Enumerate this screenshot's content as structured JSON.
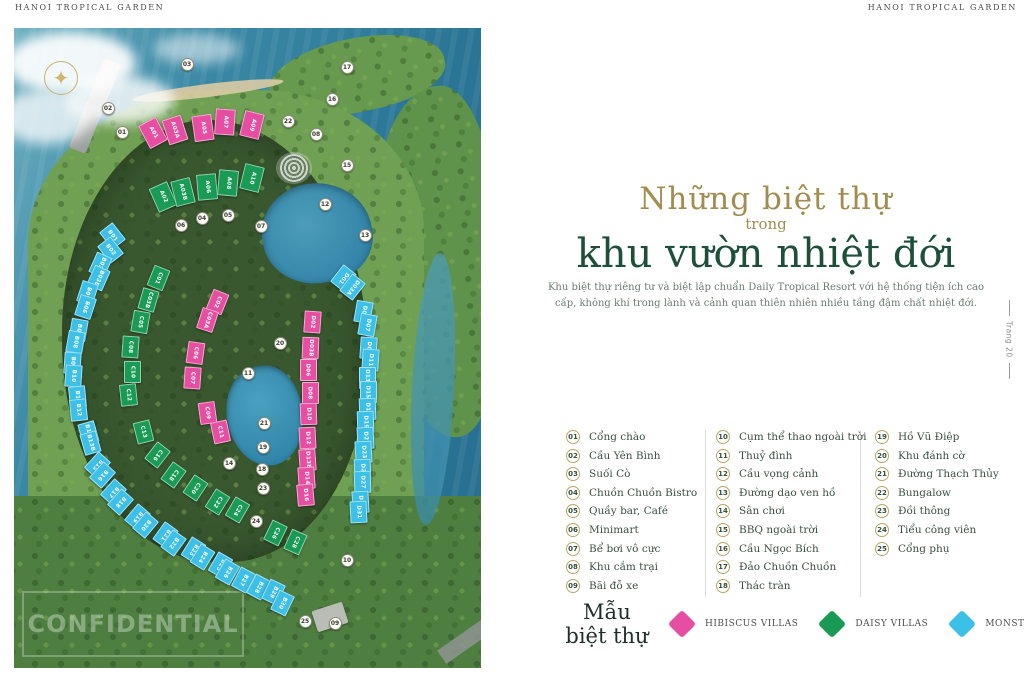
{
  "header": {
    "left": "HANOI TROPICAL GARDEN",
    "right": "HANOI TROPICAL GARDEN"
  },
  "page_tab": "Trang 20",
  "title": {
    "line1": "Những biệt thự",
    "line2": "trong",
    "line3": "khu vườn nhiệt đới"
  },
  "description": "Khu biệt thự riêng tư và biệt lập chuẩn Daily Tropical Resort với hệ thống tiện ích cao cấp, không khí trong lành và cảnh quan thiên nhiên nhiều tầng đậm chất nhiệt đới.",
  "legend": {
    "columns": [
      [
        {
          "num": "01",
          "label": "Cổng chào"
        },
        {
          "num": "02",
          "label": "Cầu Yên Bình"
        },
        {
          "num": "03",
          "label": "Suối Cò"
        },
        {
          "num": "04",
          "label": "Chuồn Chuồn Bistro"
        },
        {
          "num": "05",
          "label": "Quầy bar, Café"
        },
        {
          "num": "06",
          "label": "Minimart"
        },
        {
          "num": "07",
          "label": "Bể bơi vô cực"
        },
        {
          "num": "08",
          "label": "Khu cắm trại"
        },
        {
          "num": "09",
          "label": "Bãi đỗ xe"
        }
      ],
      [
        {
          "num": "10",
          "label": "Cụm thể thao ngoài trời"
        },
        {
          "num": "11",
          "label": "Thuỷ đình"
        },
        {
          "num": "12",
          "label": "Cầu vọng cảnh"
        },
        {
          "num": "13",
          "label": "Đường dạo ven hồ"
        },
        {
          "num": "14",
          "label": "Sân chơi"
        },
        {
          "num": "15",
          "label": "BBQ ngoài trời"
        },
        {
          "num": "16",
          "label": "Cầu Ngọc Bích"
        },
        {
          "num": "17",
          "label": "Đảo Chuồn Chuồn"
        },
        {
          "num": "18",
          "label": "Thác tràn"
        }
      ],
      [
        {
          "num": "19",
          "label": "Hồ Vũ Điệp"
        },
        {
          "num": "20",
          "label": "Khu đánh cờ"
        },
        {
          "num": "21",
          "label": "Đường Thạch Thủy"
        },
        {
          "num": "22",
          "label": "Bungalow"
        },
        {
          "num": "23",
          "label": "Đồi thông"
        },
        {
          "num": "24",
          "label": "Tiểu công viên"
        },
        {
          "num": "25",
          "label": "Cổng phụ"
        }
      ]
    ]
  },
  "villa_types": {
    "title_line1": "Mẫu",
    "title_line2": "biệt thự",
    "items": [
      {
        "name": "HIBISCUS VILLAS",
        "color": "#e64fa1"
      },
      {
        "name": "DAISY VILLAS",
        "color": "#199a55"
      },
      {
        "name": "MONSTERA VILLAS",
        "color": "#3cc0e8"
      }
    ]
  },
  "map": {
    "watermark": "CONFIDENTIAL",
    "compass_icon": "✦",
    "villas": [
      [
        "A01",
        "h",
        139,
        105,
        -28
      ],
      [
        "A03A",
        "h",
        161,
        102,
        -18
      ],
      [
        "A05",
        "h",
        189,
        100,
        -8
      ],
      [
        "A07",
        "h",
        211,
        94,
        4
      ],
      [
        "A09",
        "h",
        238,
        97,
        14
      ],
      [
        "A02",
        "d",
        149,
        169,
        -24
      ],
      [
        "A03B",
        "d",
        169,
        164,
        -14
      ],
      [
        "A06",
        "d",
        193,
        159,
        -5
      ],
      [
        "A08",
        "d",
        214,
        155,
        5
      ],
      [
        "A10",
        "d",
        238,
        150,
        14
      ],
      [
        "B01",
        "m",
        98,
        208,
        -38
      ],
      [
        "B02",
        "m",
        96,
        222,
        -38
      ],
      [
        "B03A",
        "m",
        86,
        237,
        24
      ],
      [
        "B03B",
        "m",
        84,
        250,
        24
      ],
      [
        "B05",
        "m",
        73,
        265,
        18
      ],
      [
        "B06",
        "m",
        71,
        279,
        18
      ],
      [
        "B07",
        "m",
        64,
        302,
        10
      ],
      [
        "B08",
        "m",
        61,
        314,
        10
      ],
      [
        "B09",
        "m",
        58,
        335,
        4
      ],
      [
        "B10",
        "m",
        59,
        348,
        4
      ],
      [
        "B11",
        "m",
        63,
        369,
        -6
      ],
      [
        "B12",
        "m",
        64,
        382,
        -6
      ],
      [
        "B13A",
        "m",
        74,
        405,
        -16
      ],
      [
        "B13B",
        "m",
        76,
        415,
        -16
      ],
      [
        "B15",
        "m",
        83,
        437,
        42
      ],
      [
        "B16",
        "m",
        88,
        447,
        42
      ],
      [
        "B17",
        "m",
        99,
        464,
        42
      ],
      [
        "B18",
        "m",
        106,
        474,
        42
      ],
      [
        "B19",
        "m",
        123,
        489,
        40
      ],
      [
        "B20",
        "m",
        131,
        497,
        40
      ],
      [
        "B21",
        "m",
        151,
        507,
        36
      ],
      [
        "B22",
        "m",
        159,
        515,
        36
      ],
      [
        "B23",
        "m",
        179,
        522,
        32
      ],
      [
        "B24",
        "m",
        188,
        529,
        32
      ],
      [
        "B25",
        "m",
        206,
        537,
        30
      ],
      [
        "B26",
        "m",
        213,
        544,
        30
      ],
      [
        "B27",
        "m",
        229,
        552,
        28
      ],
      [
        "B28",
        "m",
        244,
        559,
        28
      ],
      [
        "B29",
        "m",
        259,
        564,
        26
      ],
      [
        "B30",
        "m",
        268,
        575,
        26
      ],
      [
        "C01",
        "d",
        144,
        250,
        22
      ],
      [
        "C03B",
        "d",
        134,
        272,
        16
      ],
      [
        "C05",
        "d",
        126,
        294,
        10
      ],
      [
        "C08",
        "d",
        116,
        319,
        4
      ],
      [
        "C10",
        "d",
        118,
        344,
        0
      ],
      [
        "C12",
        "d",
        114,
        367,
        -6
      ],
      [
        "C13",
        "d",
        129,
        404,
        -14
      ],
      [
        "C16",
        "d",
        143,
        427,
        38
      ],
      [
        "C18",
        "d",
        159,
        447,
        36
      ],
      [
        "C20",
        "d",
        181,
        460,
        34
      ],
      [
        "C22",
        "d",
        203,
        474,
        32
      ],
      [
        "C24",
        "d",
        223,
        482,
        30
      ],
      [
        "C26",
        "d",
        261,
        505,
        26
      ],
      [
        "C28",
        "d",
        281,
        514,
        24
      ],
      [
        "C02",
        "h",
        203,
        274,
        22
      ],
      [
        "C03A",
        "h",
        193,
        292,
        18
      ],
      [
        "C06",
        "h",
        181,
        325,
        8
      ],
      [
        "C07",
        "h",
        178,
        350,
        4
      ],
      [
        "C09",
        "h",
        193,
        385,
        -8
      ],
      [
        "C11",
        "h",
        206,
        404,
        -12
      ],
      [
        "D02",
        "h",
        298,
        294,
        4
      ],
      [
        "D03B",
        "h",
        296,
        320,
        2
      ],
      [
        "D06",
        "h",
        294,
        342,
        0
      ],
      [
        "D08",
        "h",
        296,
        365,
        0
      ],
      [
        "D10",
        "h",
        294,
        386,
        -2
      ],
      [
        "D12",
        "h",
        293,
        410,
        -3
      ],
      [
        "D13B",
        "h",
        293,
        432,
        -4
      ],
      [
        "D14",
        "h",
        292,
        450,
        -4
      ],
      [
        "D16",
        "h",
        291,
        467,
        -5
      ],
      [
        "D01",
        "m",
        329,
        250,
        38
      ],
      [
        "D03A",
        "m",
        338,
        259,
        38
      ],
      [
        "D05",
        "m",
        349,
        284,
        10
      ],
      [
        "D07",
        "m",
        353,
        297,
        10
      ],
      [
        "D09",
        "m",
        354,
        320,
        4
      ],
      [
        "D11",
        "m",
        356,
        332,
        4
      ],
      [
        "D13A",
        "m",
        353,
        350,
        0
      ],
      [
        "D15",
        "m",
        354,
        364,
        0
      ],
      [
        "D17",
        "m",
        353,
        381,
        -2
      ],
      [
        "D19",
        "m",
        351,
        394,
        -2
      ],
      [
        "D21",
        "m",
        351,
        410,
        -3
      ],
      [
        "D23",
        "m",
        349,
        424,
        -3
      ],
      [
        "D25",
        "m",
        348,
        442,
        -2
      ],
      [
        "D27",
        "m",
        348,
        454,
        -2
      ],
      [
        "D29",
        "m",
        346,
        474,
        -3
      ],
      [
        "D31",
        "m",
        344,
        484,
        -3
      ]
    ],
    "markers": [
      [
        "01",
        108,
        104
      ],
      [
        "02",
        94,
        80
      ],
      [
        "03",
        173,
        36
      ],
      [
        "04",
        188,
        190
      ],
      [
        "05",
        214,
        187
      ],
      [
        "06",
        167,
        197
      ],
      [
        "07",
        247,
        198
      ],
      [
        "08",
        302,
        106
      ],
      [
        "09",
        321,
        595
      ],
      [
        "10",
        333,
        532
      ],
      [
        "11",
        234,
        345
      ],
      [
        "12",
        311,
        176
      ],
      [
        "13",
        351,
        207
      ],
      [
        "14",
        215,
        435
      ],
      [
        "15",
        333,
        137
      ],
      [
        "16",
        318,
        71
      ],
      [
        "17",
        333,
        39
      ],
      [
        "18",
        248,
        441
      ],
      [
        "19",
        249,
        419
      ],
      [
        "20",
        266,
        315
      ],
      [
        "21",
        250,
        395
      ],
      [
        "22",
        274,
        93
      ],
      [
        "23",
        249,
        460
      ],
      [
        "24",
        242,
        493
      ],
      [
        "25",
        291,
        593
      ]
    ]
  }
}
